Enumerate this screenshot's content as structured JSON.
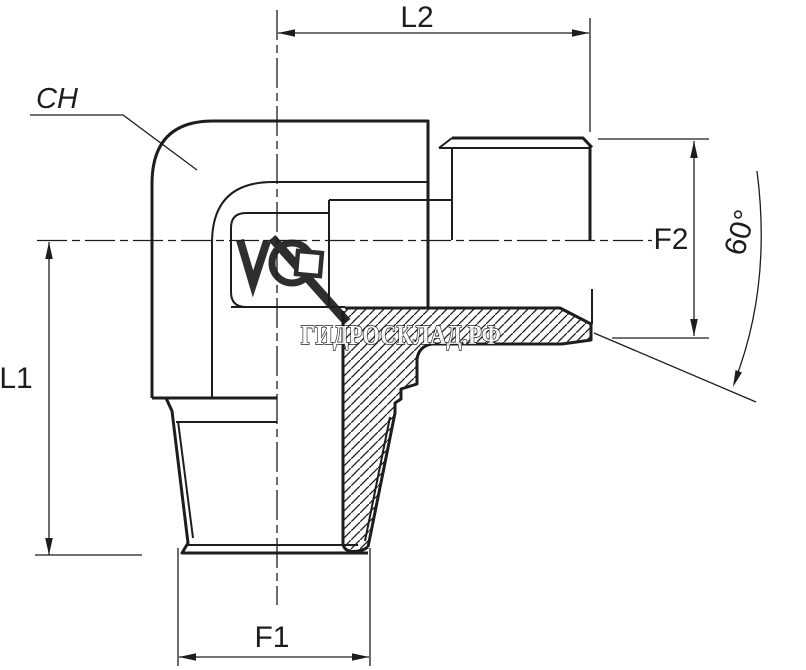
{
  "drawing": {
    "description": "90 degree elbow adapter fitting, male taper thread bottom, male stud with 60 degree cone seat right, shown in half-section",
    "labels": {
      "l1": "L1",
      "l2": "L2",
      "f1": "F1",
      "f2": "F2",
      "angle": "60°",
      "wrench_size": "CH"
    },
    "watermark": {
      "text": "ГИДРОСКЛАД.РФ"
    },
    "colors": {
      "line": "#1d1d1d",
      "background": "#ffffff"
    }
  }
}
